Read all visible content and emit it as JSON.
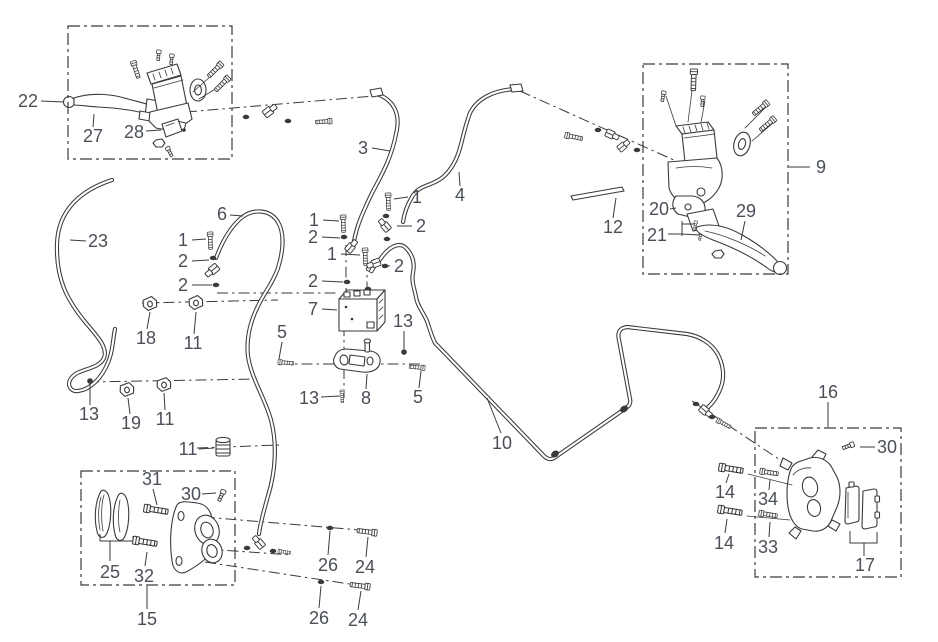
{
  "colors": {
    "line": "#3a3a3a",
    "label": "#4a4f58",
    "background": "#ffffff"
  },
  "assembly_boxes": [
    {
      "name": "front-master-cylinder-assembly-box",
      "x": 68,
      "y": 26,
      "w": 164,
      "h": 133
    },
    {
      "name": "rear-master-cylinder-assembly-box",
      "x": 643,
      "y": 64,
      "w": 145,
      "h": 210
    },
    {
      "name": "front-caliper-assembly-box",
      "x": 81,
      "y": 471,
      "w": 154,
      "h": 114
    },
    {
      "name": "rear-caliper-assembly-box",
      "x": 755,
      "y": 428,
      "w": 146,
      "h": 149
    }
  ],
  "callouts": [
    {
      "label": "22",
      "x": 28,
      "y": 101,
      "leader": [
        41,
        101,
        64,
        102
      ]
    },
    {
      "label": "27",
      "x": 93,
      "y": 136,
      "leader": [
        93,
        127,
        94,
        114
      ]
    },
    {
      "label": "28",
      "x": 134,
      "y": 132,
      "leader": [
        146,
        131,
        161,
        130
      ]
    },
    {
      "label": "23",
      "x": 98,
      "y": 241,
      "leader": [
        86,
        241,
        70,
        240
      ]
    },
    {
      "label": "6",
      "x": 222,
      "y": 214,
      "leader": [
        230,
        215,
        243,
        216
      ]
    },
    {
      "label": "1",
      "x": 183,
      "y": 240,
      "leader": [
        192,
        240,
        206,
        239
      ]
    },
    {
      "label": "2",
      "x": 183,
      "y": 261,
      "leader": [
        192,
        261,
        209,
        260
      ]
    },
    {
      "label": "2",
      "x": 183,
      "y": 285,
      "leader": [
        192,
        285,
        212,
        285
      ]
    },
    {
      "label": "3",
      "x": 363,
      "y": 148,
      "leader": [
        372,
        148,
        390,
        151
      ]
    },
    {
      "label": "1",
      "x": 314,
      "y": 220,
      "leader": [
        323,
        220,
        339,
        221
      ]
    },
    {
      "label": "2",
      "x": 313,
      "y": 237,
      "leader": [
        322,
        237,
        340,
        238
      ]
    },
    {
      "label": "1",
      "x": 332,
      "y": 254,
      "leader": [
        341,
        254,
        360,
        255
      ]
    },
    {
      "label": "2",
      "x": 313,
      "y": 281,
      "leader": [
        322,
        281,
        343,
        282
      ]
    },
    {
      "label": "7",
      "x": 313,
      "y": 309,
      "leader": [
        322,
        309,
        337,
        310
      ]
    },
    {
      "label": "2",
      "x": 399,
      "y": 266,
      "leader": [
        390,
        266,
        382,
        265
      ]
    },
    {
      "label": "1",
      "x": 417,
      "y": 197,
      "leader": [
        408,
        197,
        394,
        199
      ]
    },
    {
      "label": "2",
      "x": 421,
      "y": 226,
      "leader": [
        412,
        226,
        397,
        226
      ]
    },
    {
      "label": "4",
      "x": 460,
      "y": 195,
      "leader": [
        460,
        186,
        459,
        172
      ]
    },
    {
      "label": "13",
      "x": 403,
      "y": 321,
      "leader": [
        404,
        331,
        404,
        349
      ]
    },
    {
      "label": "5",
      "x": 282,
      "y": 332,
      "leader": [
        282,
        342,
        279,
        359
      ]
    },
    {
      "label": "13",
      "x": 309,
      "y": 398,
      "leader": [
        321,
        397,
        340,
        396
      ]
    },
    {
      "label": "8",
      "x": 366,
      "y": 398,
      "leader": [
        366,
        389,
        367,
        374
      ]
    },
    {
      "label": "5",
      "x": 418,
      "y": 397,
      "leader": [
        419,
        388,
        421,
        371
      ]
    },
    {
      "label": "12",
      "x": 613,
      "y": 227,
      "leader": [
        613,
        218,
        616,
        198
      ]
    },
    {
      "label": "9",
      "x": 821,
      "y": 167,
      "leader": [
        810,
        167,
        789,
        167
      ]
    },
    {
      "label": "20",
      "x": 659,
      "y": 209,
      "leader": [
        670,
        209,
        676,
        208
      ]
    },
    {
      "label": "21",
      "x": 657,
      "y": 235,
      "leader": [
        668,
        234,
        682,
        234
      ]
    },
    {
      "label": "29",
      "x": 746,
      "y": 211,
      "leader": [
        745,
        221,
        741,
        240
      ]
    },
    {
      "label": "18",
      "x": 146,
      "y": 338,
      "leader": [
        147,
        329,
        150,
        312
      ]
    },
    {
      "label": "11",
      "x": 193,
      "y": 343,
      "leader": [
        194,
        334,
        196,
        312
      ]
    },
    {
      "label": "13",
      "x": 89,
      "y": 414,
      "leader": [
        90,
        405,
        90,
        385
      ]
    },
    {
      "label": "19",
      "x": 131,
      "y": 423,
      "leader": [
        130,
        414,
        128,
        398
      ]
    },
    {
      "label": "11",
      "x": 165,
      "y": 419,
      "leader": [
        165,
        410,
        164,
        393
      ]
    },
    {
      "label": "11",
      "x": 188,
      "y": 449,
      "leader": [
        199,
        449,
        214,
        448
      ]
    },
    {
      "label": "10",
      "x": 502,
      "y": 443,
      "leader": [
        501,
        433,
        487,
        398
      ]
    },
    {
      "label": "31",
      "x": 152,
      "y": 479,
      "leader": [
        153,
        489,
        157,
        505
      ]
    },
    {
      "label": "30",
      "x": 191,
      "y": 494,
      "leader": [
        202,
        494,
        216,
        493
      ]
    },
    {
      "label": "25",
      "x": 110,
      "y": 572,
      "leader": null
    },
    {
      "label": "32",
      "x": 144,
      "y": 576,
      "leader": [
        145,
        566,
        147,
        552
      ]
    },
    {
      "label": "15",
      "x": 147,
      "y": 619,
      "leader": [
        147,
        609,
        147,
        586
      ]
    },
    {
      "label": "26",
      "x": 328,
      "y": 565,
      "leader": [
        328,
        555,
        330,
        531
      ]
    },
    {
      "label": "24",
      "x": 365,
      "y": 567,
      "leader": [
        366,
        557,
        368,
        537
      ]
    },
    {
      "label": "26",
      "x": 319,
      "y": 618,
      "leader": [
        319,
        608,
        321,
        586
      ]
    },
    {
      "label": "24",
      "x": 358,
      "y": 620,
      "leader": [
        358,
        610,
        361,
        591
      ]
    },
    {
      "label": "16",
      "x": 828,
      "y": 392,
      "leader": [
        828,
        402,
        828,
        427
      ]
    },
    {
      "label": "30",
      "x": 887,
      "y": 447,
      "leader": [
        875,
        447,
        860,
        447
      ]
    },
    {
      "label": "14",
      "x": 725,
      "y": 492,
      "leader": [
        726,
        483,
        729,
        474
      ]
    },
    {
      "label": "34",
      "x": 768,
      "y": 499,
      "leader": [
        769,
        490,
        770,
        480
      ]
    },
    {
      "label": "14",
      "x": 724,
      "y": 543,
      "leader": [
        725,
        533,
        727,
        519
      ]
    },
    {
      "label": "33",
      "x": 768,
      "y": 547,
      "leader": [
        769,
        537,
        770,
        522
      ]
    },
    {
      "label": "17",
      "x": 865,
      "y": 565,
      "leader": null
    }
  ]
}
